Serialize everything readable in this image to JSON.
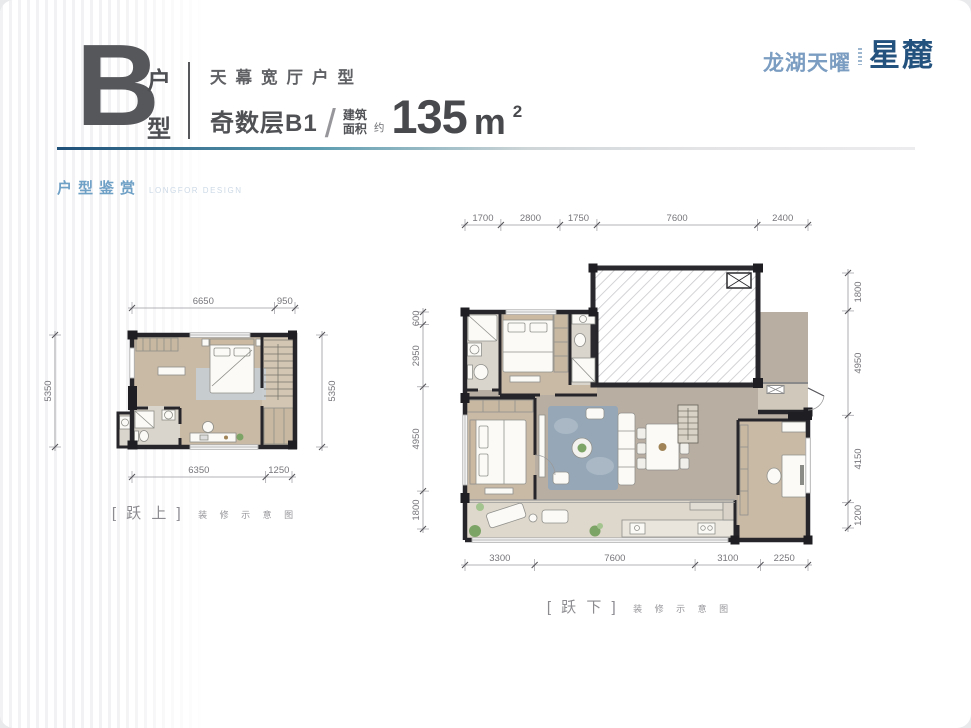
{
  "header": {
    "unit_letter": "B",
    "unit_type_top": "户",
    "unit_type_bottom": "型",
    "tagline": "天幕宽厅户型",
    "floor_label": "奇数层B1",
    "slash": "/",
    "area_label_top": "建筑",
    "area_label_bottom": "面积",
    "area_approx": "约",
    "area_value": "135",
    "area_unit": "m",
    "area_sup": "2"
  },
  "logo": {
    "brand": "龙湖天曜",
    "product": "星麓"
  },
  "section": {
    "title": "户型鉴赏",
    "subtitle": "LONGFOR DESIGN"
  },
  "colors": {
    "title_blue": "#6fa0c6",
    "logo_light": "#7b9dc1",
    "logo_dark": "#24527e",
    "rule_start": "#1f5078",
    "rule_mid": "#5b9cb0",
    "dim_text": "#76767b"
  },
  "plans": {
    "upper": {
      "label": "[ 跃 上 ]",
      "caption": "装 修 示 意 图",
      "dims": {
        "top": [
          6650,
          950
        ],
        "bottom": [
          6350,
          1250
        ],
        "left": [
          5350
        ],
        "right": [
          5350
        ]
      }
    },
    "lower": {
      "label": "[ 跃 下 ]",
      "caption": "装 修 示 意 图",
      "dims": {
        "top": [
          1700,
          2800,
          1750,
          7600,
          2400
        ],
        "left": [
          600,
          2950,
          4950,
          1800
        ],
        "right": [
          1800,
          4950,
          4150,
          1200
        ],
        "bottom": [
          3300,
          7600,
          3100,
          2250
        ]
      }
    }
  }
}
